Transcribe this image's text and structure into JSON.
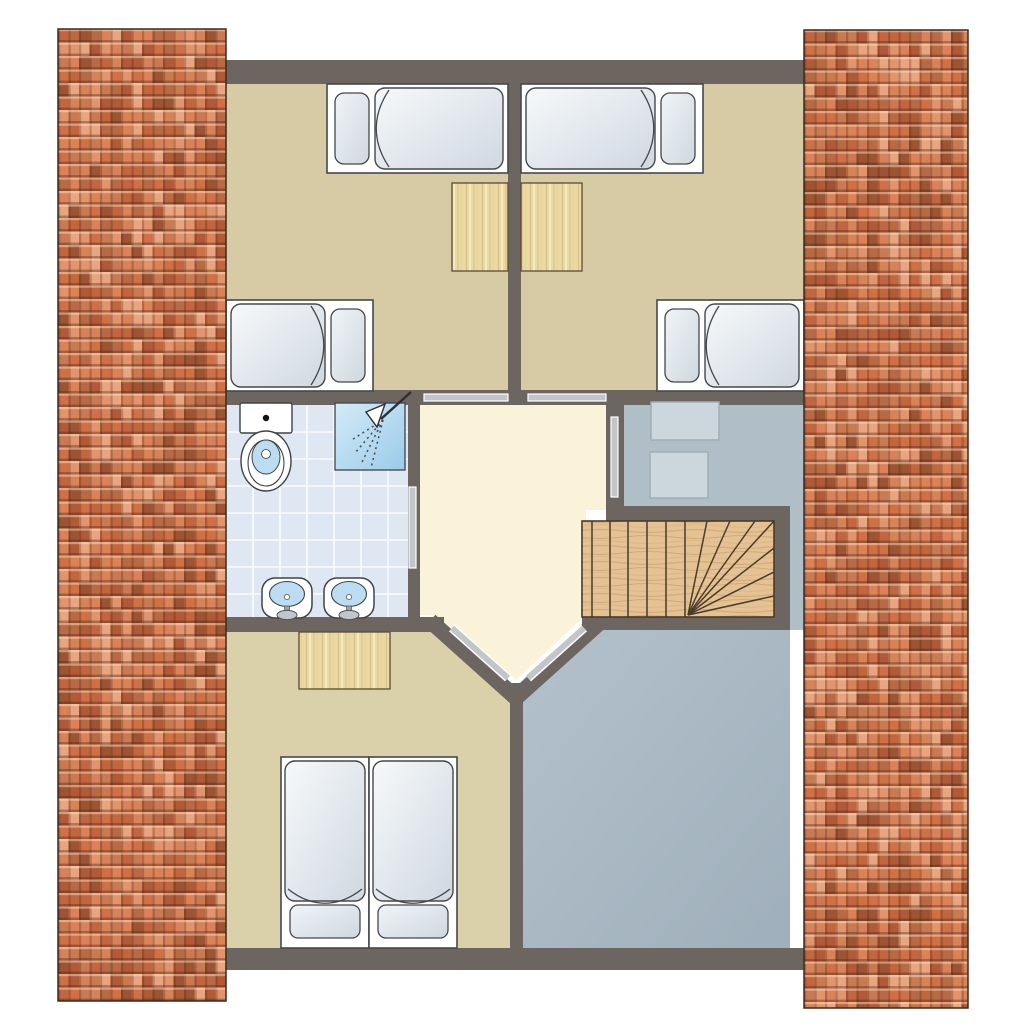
{
  "meta": {
    "title": "attic-floor-plan"
  },
  "canvas": {
    "width": 1024,
    "height": 1024,
    "background": "#ffffff"
  },
  "colors": {
    "wall": "#6d6660",
    "bedroom_floor": "#d6cba5",
    "bedroom_bottom_floor": "#dad0a9",
    "hall_floor": "#faf3d9",
    "bathroom_floor": "#dfe7f3",
    "bath_grid": "#ffffff",
    "gray_room_light": "#b4c2cc",
    "gray_room_dark": "#9fafbb",
    "storage_room": "#b0bec8",
    "door_bar": "#c3c6c9",
    "stair_wood": "#e4c293",
    "stair_line": "#4a3b2a",
    "desk_wood": "#ead9a4",
    "bed_outline": "#44484c",
    "cabinet_fill": "#ccd6dd",
    "cabinet_stroke": "#9fadb6",
    "water": "#bcdcf2",
    "roof_border": "#3a2a1e",
    "roof_palette": [
      "#dc8258",
      "#cf7046",
      "#c2663f",
      "#b05a38",
      "#e2946c",
      "#d7835a",
      "#9d5433",
      "#c97a52",
      "#e8a57f",
      "#b86a45"
    ]
  },
  "roofs": [
    {
      "name": "roof-left",
      "x": 58,
      "y": 29,
      "w": 168,
      "h": 972,
      "seed": 7
    },
    {
      "name": "roof-right",
      "x": 804,
      "y": 30,
      "w": 164,
      "h": 978,
      "seed": 29
    }
  ],
  "roof_tile": {
    "w": 10.5,
    "h": 13.5
  },
  "floors": [
    {
      "name": "bedroom-top-left-floor",
      "color_key": "bedroom_floor",
      "rect": [
        226,
        84,
        282,
        306
      ]
    },
    {
      "name": "bedroom-top-right-floor",
      "color_key": "bedroom_floor",
      "rect": [
        521,
        84,
        283,
        306
      ]
    },
    {
      "name": "bathroom-floor",
      "color_key": "bathroom_floor",
      "rect": [
        226,
        405,
        182,
        217
      ]
    },
    {
      "name": "hallway-floor",
      "color_key": "hall_floor",
      "points": [
        [
          414,
          392
        ],
        [
          624,
          392
        ],
        [
          624,
          510
        ],
        [
          586,
          510
        ],
        [
          586,
          615
        ],
        [
          516,
          680
        ],
        [
          436,
          615
        ],
        [
          414,
          615
        ]
      ]
    },
    {
      "name": "storage-room-floor",
      "color_key": "storage_room",
      "rect": [
        612,
        395,
        192,
        118
      ]
    },
    {
      "name": "stairwell-strip-floor",
      "color_key": "storage_room",
      "rect": [
        782,
        500,
        22,
        130
      ]
    },
    {
      "name": "open-room-floor",
      "color_key": "gray_gradient",
      "points": [
        [
          516,
          686
        ],
        [
          590,
          616
        ],
        [
          790,
          616
        ],
        [
          790,
          948
        ],
        [
          516,
          948
        ]
      ]
    },
    {
      "name": "bedroom-bottom-floor",
      "color_key": "bedroom_bottom_floor",
      "points": [
        [
          226,
          626
        ],
        [
          436,
          626
        ],
        [
          516,
          698
        ],
        [
          516,
          948
        ],
        [
          226,
          948
        ]
      ]
    }
  ],
  "walls": [
    {
      "name": "wall-outer-top",
      "rect": [
        226,
        60,
        578,
        24
      ]
    },
    {
      "name": "wall-outer-bottom",
      "rect": [
        226,
        948,
        578,
        22
      ]
    },
    {
      "name": "wall-mid-horizontal",
      "rect": [
        226,
        390,
        578,
        15
      ]
    },
    {
      "name": "wall-center-divider",
      "rect": [
        508,
        84,
        13,
        306
      ]
    },
    {
      "name": "wall-bath-hall",
      "rect": [
        408,
        405,
        12,
        217
      ]
    },
    {
      "name": "wall-bath-bottom",
      "rect": [
        226,
        617,
        218,
        15
      ]
    },
    {
      "name": "wall-hall-right",
      "rect": [
        606,
        405,
        18,
        101
      ]
    },
    {
      "name": "wall-stairs-top",
      "rect": [
        606,
        506,
        184,
        15
      ]
    },
    {
      "name": "wall-stairs-right",
      "rect": [
        774,
        521,
        16,
        109
      ]
    },
    {
      "name": "wall-stairs-bottom",
      "rect": [
        582,
        616,
        208,
        14
      ]
    },
    {
      "name": "wall-bottom-divider",
      "rect": [
        510,
        683,
        13,
        265
      ]
    },
    {
      "name": "wall-diagonal-left",
      "line": [
        436,
        626,
        514,
        696
      ],
      "width": 16
    },
    {
      "name": "wall-diagonal-right",
      "line": [
        518,
        696,
        598,
        624
      ],
      "width": 16
    }
  ],
  "doors": [
    {
      "name": "door-bedroom-top-left",
      "rect": [
        424,
        394,
        84,
        7
      ]
    },
    {
      "name": "door-bedroom-top-right",
      "rect": [
        528,
        394,
        78,
        7
      ]
    },
    {
      "name": "door-bathroom",
      "rect": [
        409,
        487,
        7,
        81
      ]
    },
    {
      "name": "door-storage-room",
      "rect": [
        611,
        417,
        7,
        80
      ]
    },
    {
      "name": "door-bedroom-bottom",
      "line": [
        452,
        628,
        508,
        678
      ],
      "width": 6
    },
    {
      "name": "door-open-room",
      "line": [
        528,
        678,
        584,
        628
      ],
      "width": 6
    }
  ],
  "beds": [
    {
      "name": "bed-top-left-a",
      "x": 327,
      "y": 84,
      "w": 181,
      "h": 89,
      "pillow": "left"
    },
    {
      "name": "bed-top-left-b",
      "x": 226,
      "y": 300,
      "w": 147,
      "h": 91,
      "pillow": "right"
    },
    {
      "name": "bed-top-right-a",
      "x": 521,
      "y": 84,
      "w": 182,
      "h": 89,
      "pillow": "right"
    },
    {
      "name": "bed-top-right-b",
      "x": 657,
      "y": 300,
      "w": 147,
      "h": 91,
      "pillow": "left"
    },
    {
      "name": "bed-double-left",
      "x": 281,
      "y": 757,
      "w": 88,
      "h": 191,
      "pillow": "bottom"
    },
    {
      "name": "bed-double-right",
      "x": 369,
      "y": 757,
      "w": 88,
      "h": 191,
      "pillow": "bottom"
    }
  ],
  "desks": [
    {
      "name": "desk-top-left-room",
      "rect": [
        452,
        183,
        56,
        88
      ]
    },
    {
      "name": "desk-top-right-room",
      "rect": [
        521,
        183,
        61,
        88
      ]
    },
    {
      "name": "desk-bottom-room",
      "rect": [
        299,
        632,
        91,
        57
      ]
    }
  ],
  "cabinets": [
    {
      "name": "cabinet-upper",
      "rect": [
        651,
        402,
        68,
        38
      ]
    },
    {
      "name": "cabinet-lower",
      "rect": [
        650,
        452,
        58,
        46
      ]
    }
  ],
  "stairs": {
    "name": "winder-staircase",
    "rect": [
      582,
      521,
      192,
      96
    ],
    "straight_lines_x": [
      592,
      610,
      628,
      647,
      666,
      685
    ],
    "winder_origin": [
      688,
      615
    ],
    "winder_targets": [
      [
        707,
        521
      ],
      [
        730,
        521
      ],
      [
        755,
        521
      ],
      [
        774,
        521
      ],
      [
        774,
        548
      ],
      [
        774,
        572
      ],
      [
        774,
        596
      ]
    ]
  },
  "bathroom": {
    "tile_size": 27,
    "toilet": {
      "name": "toilet",
      "tank": [
        240,
        403,
        52,
        30
      ],
      "button": [
        266,
        418
      ],
      "bowl_center": [
        266,
        461
      ]
    },
    "shower": {
      "name": "shower",
      "rect": [
        335,
        403,
        70,
        67
      ],
      "head": [
        377,
        416
      ]
    },
    "sinks": [
      {
        "name": "sink-left",
        "rect": [
          262,
          578,
          50,
          40
        ]
      },
      {
        "name": "sink-right",
        "rect": [
          324,
          578,
          50,
          40
        ]
      }
    ]
  }
}
